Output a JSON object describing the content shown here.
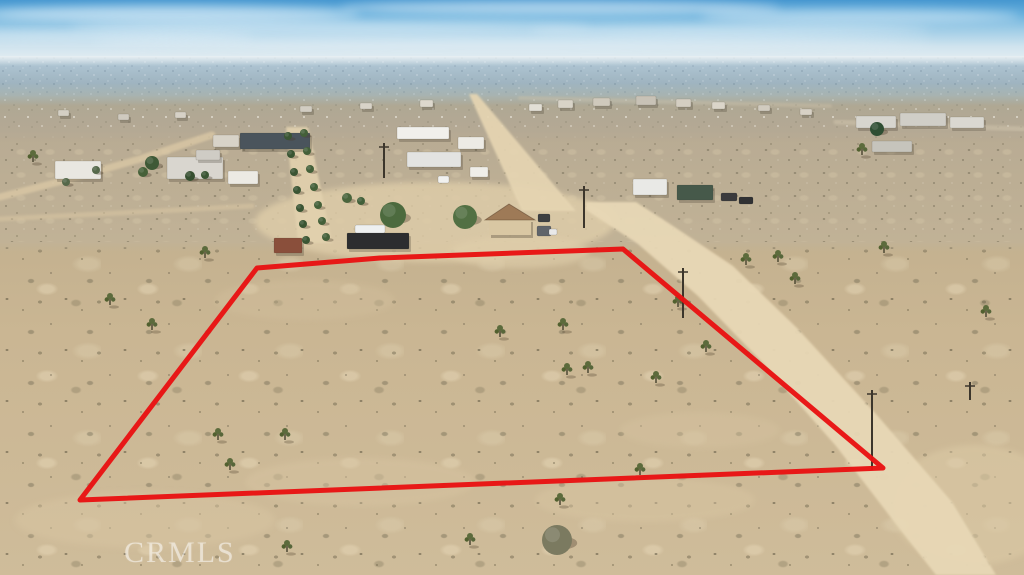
{
  "watermark": {
    "text": "CRMLS"
  },
  "palette": {
    "sky_top": "#4697d0",
    "sky_haze": "#e9f0f3",
    "city_band": "#a3b9c7",
    "town_band": "#b2a692",
    "mid_desert": "#bcae95",
    "foreground_sand": "#cab693",
    "road_sand": "#e8d8b6",
    "boundary_red": "#e81313"
  },
  "scene": {
    "clouds": [
      [
        170,
        14,
        190,
        8,
        0.55
      ],
      [
        560,
        8,
        220,
        7,
        0.5
      ],
      [
        860,
        16,
        160,
        7,
        0.45
      ],
      [
        330,
        27,
        260,
        6,
        0.4
      ],
      [
        730,
        30,
        200,
        6,
        0.35
      ],
      [
        95,
        36,
        160,
        5,
        0.35
      ],
      [
        512,
        42,
        420,
        6,
        0.3
      ]
    ],
    "patches": [
      [
        435,
        222,
        180,
        40,
        "#dfcda9",
        0.8
      ],
      [
        520,
        252,
        70,
        16,
        "#e0cfab",
        0.6
      ],
      [
        145,
        520,
        130,
        28,
        "#d8c5a2",
        0.5
      ],
      [
        360,
        482,
        115,
        24,
        "#d8c5a2",
        0.45
      ],
      [
        645,
        500,
        110,
        22,
        "#d9c6a3",
        0.45
      ],
      [
        975,
        505,
        85,
        60,
        "#dccaa6",
        0.55
      ],
      [
        305,
        300,
        90,
        20,
        "#d3c09d",
        0.4
      ],
      [
        700,
        430,
        80,
        18,
        "#d6c3a0",
        0.4
      ]
    ],
    "road_polys": [
      {
        "name": "road-central",
        "c": "#e6d5b2",
        "o": 0.92,
        "pts": [
          [
            469,
            94
          ],
          [
            477,
            94
          ],
          [
            576,
            211
          ],
          [
            522,
            211
          ]
        ]
      },
      {
        "name": "road-main-diagonal",
        "c": "#e8d8b6",
        "o": 0.95,
        "pts": [
          [
            586,
            202
          ],
          [
            636,
            202
          ],
          [
            670,
            224
          ],
          [
            733,
            266
          ],
          [
            797,
            328
          ],
          [
            876,
            414
          ],
          [
            952,
            502
          ],
          [
            996,
            575
          ],
          [
            936,
            575
          ],
          [
            902,
            532
          ],
          [
            836,
            446
          ],
          [
            762,
            362
          ],
          [
            698,
            296
          ],
          [
            638,
            244
          ],
          [
            586,
            210
          ]
        ]
      },
      {
        "name": "road-driveway",
        "c": "#e2d1ae",
        "o": 0.9,
        "pts": [
          [
            286,
            127
          ],
          [
            308,
            127
          ],
          [
            332,
            243
          ],
          [
            298,
            243
          ]
        ]
      }
    ],
    "road_lines": [
      {
        "name": "road-left",
        "c": "#dcc9a6",
        "o": 0.75,
        "w": 7,
        "pts": [
          [
            0,
            197
          ],
          [
            70,
            179
          ],
          [
            140,
            159
          ],
          [
            212,
            135
          ]
        ]
      },
      {
        "name": "trail-left",
        "c": "#d9c6a3",
        "o": 0.55,
        "w": 5,
        "pts": [
          [
            0,
            219
          ],
          [
            120,
            213
          ],
          [
            252,
            206
          ]
        ]
      },
      {
        "name": "road-top-right",
        "c": "#d2c6ae",
        "o": 0.5,
        "w": 5,
        "pts": [
          [
            836,
            122
          ],
          [
            1023,
            129
          ]
        ]
      },
      {
        "name": "road-town",
        "c": "#cfc3ab",
        "o": 0.4,
        "w": 4,
        "pts": [
          [
            520,
            98
          ],
          [
            830,
            106
          ]
        ]
      }
    ],
    "buildings": [
      [
        55,
        161,
        46,
        18,
        "#e9e7e1",
        "house-left"
      ],
      [
        167,
        157,
        56,
        22,
        "#d9d6cf",
        "house-left-main"
      ],
      [
        196,
        150,
        24,
        10,
        "#cfccc5",
        "house-left-wing"
      ],
      [
        213,
        135,
        26,
        12,
        "#d8d3c8",
        "outbuilding"
      ],
      [
        240,
        133,
        70,
        16,
        "#4a545c",
        "dark-hangar"
      ],
      [
        228,
        171,
        30,
        13,
        "#eceae4",
        "white-shed"
      ],
      [
        397,
        127,
        52,
        12,
        "#f1f0ec",
        "mobile-home"
      ],
      [
        458,
        137,
        26,
        12,
        "#edebe5",
        "trailer"
      ],
      [
        407,
        152,
        54,
        15,
        "#e3e3e1",
        "long-trailer"
      ],
      [
        470,
        167,
        18,
        10,
        "#efeee9",
        "small-shed"
      ],
      [
        347,
        233,
        62,
        16,
        "#2c2d2f",
        "shipping-container"
      ],
      [
        274,
        238,
        28,
        15,
        "#8a4f3b",
        "red-shed"
      ],
      [
        633,
        179,
        34,
        16,
        "#e9e9e6",
        "rv-trailer"
      ],
      [
        677,
        185,
        36,
        15,
        "#46594a",
        "green-building"
      ],
      [
        856,
        116,
        40,
        12,
        "#d7d5ce",
        "mobile-home"
      ],
      [
        900,
        113,
        46,
        13,
        "#d0cec7",
        "mobile-home"
      ],
      [
        950,
        117,
        34,
        11,
        "#dad8d1",
        "mobile-home"
      ],
      [
        872,
        141,
        40,
        11,
        "#c6c4bc",
        "rv"
      ],
      [
        529,
        104,
        13,
        7,
        "#e2dfd5",
        "distant-house"
      ],
      [
        558,
        100,
        15,
        8,
        "#d8d3c7",
        "distant-house"
      ],
      [
        593,
        98,
        17,
        8,
        "#cfc9bc",
        "distant-house"
      ],
      [
        636,
        96,
        20,
        9,
        "#c8c2b6",
        "distant-house"
      ],
      [
        676,
        99,
        15,
        8,
        "#d4cec2",
        "distant-house"
      ],
      [
        712,
        102,
        13,
        7,
        "#dbd5c9",
        "distant-house"
      ],
      [
        758,
        105,
        12,
        6,
        "#d1cbbf",
        "distant-house"
      ],
      [
        800,
        109,
        12,
        6,
        "#d7d1c5",
        "distant-house"
      ],
      [
        58,
        110,
        11,
        6,
        "#d4cfc4",
        "distant-house"
      ],
      [
        118,
        114,
        11,
        6,
        "#cfcabf",
        "distant-house"
      ],
      [
        175,
        112,
        11,
        6,
        "#d6d1c6",
        "distant-house"
      ],
      [
        300,
        106,
        12,
        6,
        "#d2cdc2",
        "distant-house"
      ],
      [
        360,
        103,
        12,
        6,
        "#d8d3c8",
        "distant-house"
      ],
      [
        420,
        100,
        13,
        7,
        "#ddd8cd",
        "distant-house"
      ]
    ],
    "main_house": {
      "wall": [
        489,
        219,
        42,
        16
      ],
      "wall_c": "#d9c7a3",
      "roof": [
        [
          485,
          220
        ],
        [
          509,
          204
        ],
        [
          535,
          220
        ]
      ],
      "roof_c": "#9e7a57"
    },
    "vehicles": [
      [
        355,
        225,
        30,
        8,
        "#eef0f0"
      ],
      [
        438,
        176,
        11,
        7,
        "#f1f1ef"
      ],
      [
        538,
        214,
        12,
        8,
        "#3d3f41"
      ],
      [
        537,
        226,
        14,
        10,
        "#60646a"
      ],
      [
        549,
        229,
        8,
        6,
        "#e9e9e9"
      ],
      [
        721,
        193,
        16,
        8,
        "#3b3b3d"
      ],
      [
        739,
        197,
        14,
        7,
        "#303133"
      ]
    ],
    "trees": [
      [
        393,
        215,
        13,
        "#4c6a3e"
      ],
      [
        465,
        217,
        12,
        "#527043"
      ],
      [
        152,
        163,
        7,
        "#3e5936"
      ],
      [
        143,
        172,
        5,
        "#466139"
      ],
      [
        190,
        176,
        5,
        "#364f30"
      ],
      [
        205,
        175,
        4,
        "#3b5634"
      ],
      [
        877,
        129,
        7,
        "#2f4e33"
      ],
      [
        347,
        198,
        5,
        "#4a653c"
      ],
      [
        361,
        201,
        4,
        "#42603a"
      ],
      [
        288,
        136,
        4,
        "#3a5533"
      ],
      [
        304,
        133,
        4,
        "#446039"
      ],
      [
        291,
        154,
        4,
        "#3a5533"
      ],
      [
        307,
        151,
        4,
        "#446039"
      ],
      [
        294,
        172,
        4,
        "#3a5533"
      ],
      [
        310,
        169,
        4,
        "#446039"
      ],
      [
        297,
        190,
        4,
        "#3a5533"
      ],
      [
        314,
        187,
        4,
        "#446039"
      ],
      [
        300,
        208,
        4,
        "#3a5533"
      ],
      [
        318,
        205,
        4,
        "#446039"
      ],
      [
        303,
        224,
        4,
        "#3a5533"
      ],
      [
        322,
        221,
        4,
        "#446039"
      ],
      [
        306,
        240,
        4,
        "#3a5533"
      ],
      [
        326,
        237,
        4,
        "#446039"
      ],
      [
        96,
        170,
        4,
        "#55684a"
      ],
      [
        66,
        182,
        4,
        "#55684a"
      ],
      [
        557,
        540,
        15,
        "#7b7a60"
      ]
    ],
    "joshua_trees": [
      [
        152,
        330
      ],
      [
        205,
        258
      ],
      [
        218,
        440
      ],
      [
        230,
        470
      ],
      [
        285,
        440
      ],
      [
        287,
        552
      ],
      [
        500,
        337
      ],
      [
        563,
        330
      ],
      [
        567,
        375
      ],
      [
        588,
        373
      ],
      [
        656,
        383
      ],
      [
        706,
        352
      ],
      [
        678,
        307
      ],
      [
        746,
        265
      ],
      [
        778,
        262
      ],
      [
        795,
        284
      ],
      [
        884,
        253
      ],
      [
        986,
        317
      ],
      [
        862,
        155
      ],
      [
        560,
        505
      ],
      [
        470,
        545
      ],
      [
        640,
        475
      ],
      [
        33,
        162
      ],
      [
        110,
        305
      ]
    ],
    "poles": [
      [
        384,
        143,
        178
      ],
      [
        584,
        186,
        228
      ],
      [
        683,
        268,
        318
      ],
      [
        872,
        390,
        470
      ],
      [
        970,
        382,
        400
      ]
    ],
    "boundary": {
      "color": "#e81313",
      "width": 5,
      "points": [
        [
          257,
          268
        ],
        [
          380,
          258
        ],
        [
          623,
          249
        ],
        [
          883,
          468
        ],
        [
          80,
          500
        ]
      ]
    }
  }
}
